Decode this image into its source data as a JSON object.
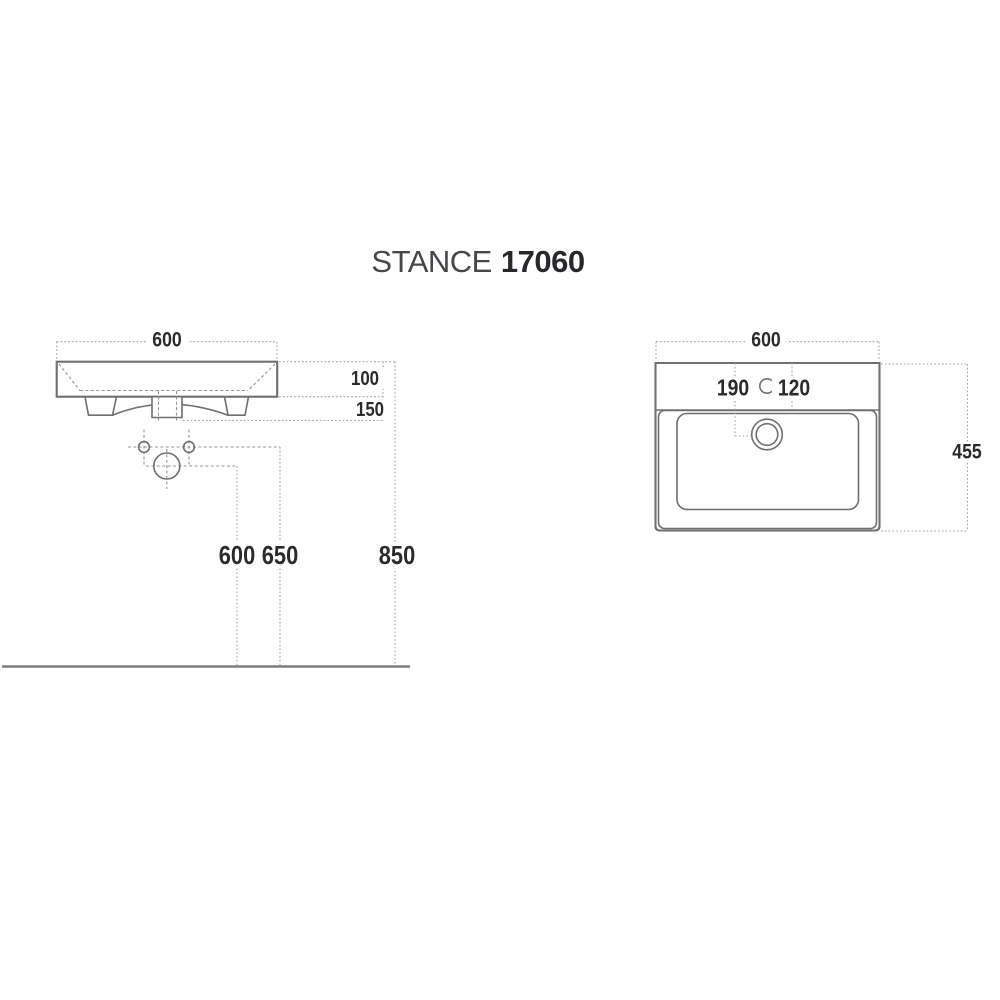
{
  "page": {
    "background": "#ffffff"
  },
  "title": {
    "brand": "STANCE",
    "model": "17060"
  },
  "views": {
    "front": {
      "label": "front elevation",
      "dims": {
        "width": "600",
        "apron_height": "100",
        "fitting_depth": "150",
        "drain_center_height": "600",
        "fixing_holes_height": "650",
        "rim_height": "850"
      }
    },
    "plan": {
      "label": "plan view",
      "dims": {
        "width": "600",
        "depth": "455",
        "drain_setback": "190",
        "tap_setback": "120"
      }
    }
  },
  "colors": {
    "outline": "#6f6f6f",
    "dashed_lines": "#9e9e9e",
    "text": "#2b2b2e",
    "floor_line": "#7e7e7e",
    "title_brand": "#47474b",
    "title_model": "#28282c"
  }
}
